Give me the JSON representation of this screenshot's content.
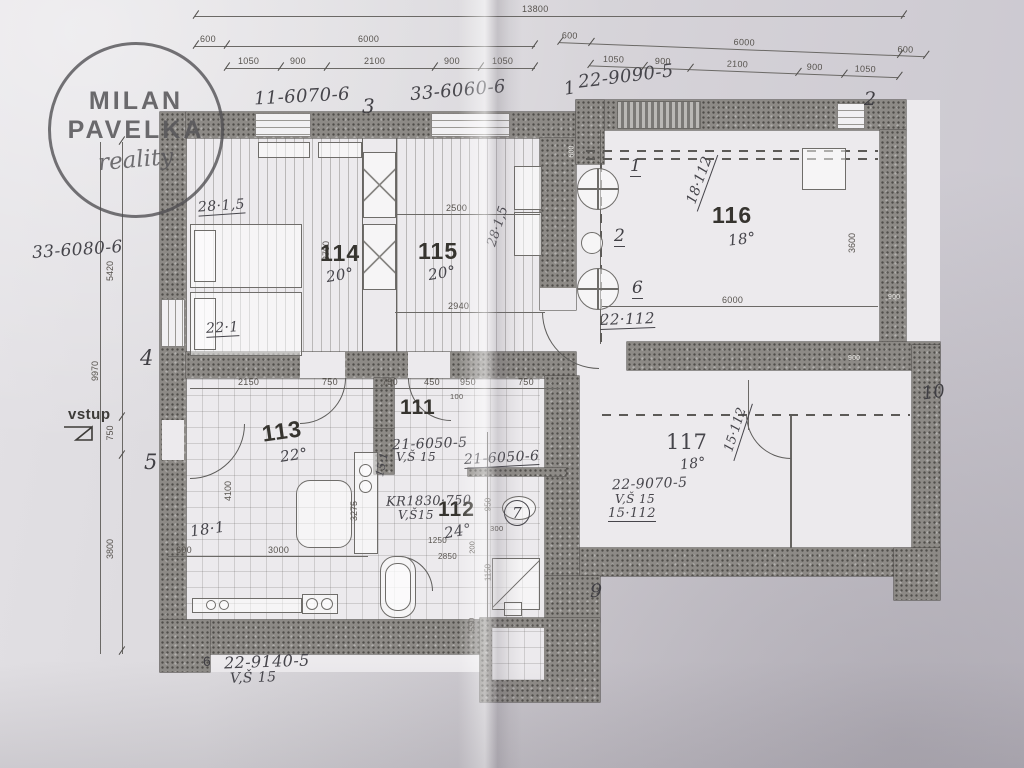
{
  "logo": {
    "line1": "MILAN",
    "line2": "PAVELKA",
    "line3": "reality"
  },
  "entrance": {
    "label": "vstup"
  },
  "rooms": {
    "r114": {
      "num": "114",
      "temp": "20°"
    },
    "r115": {
      "num": "115",
      "temp": "20°"
    },
    "r116": {
      "num": "116",
      "temp": "18°"
    },
    "r111": {
      "num": "111"
    },
    "r113": {
      "num": "113",
      "temp": "22°"
    },
    "r112": {
      "num": "112",
      "temp": "24°"
    },
    "r117": {
      "num": "117",
      "temp": "18°"
    }
  },
  "hand": {
    "ctl": "11-6070-6",
    "ctm": "33-6060-6",
    "ctr": "22-9090-5",
    "cl": "33-6080-6",
    "cb": "22-9140-5",
    "vsb": "V,Š 15",
    "a28": "28·1,5",
    "a28v": "28·1,5",
    "a18112": "18·112",
    "a221": "22·1",
    "a22112": "22·112",
    "a21505": "21-6050-5",
    "vs21": "V,Š 15",
    "a151": "15·1",
    "a21506": "21-6050-6",
    "kr": "KR1830·750",
    "vskr": "V,Š15",
    "a9070": "22-9070-5",
    "vs9070": "V,Š 15",
    "a15112": "15·112",
    "a15112v": "15·112",
    "a181": "18·1"
  },
  "markers": {
    "m1": "1",
    "m2": "2",
    "m3": "3",
    "m4": "4",
    "m5": "5",
    "m7": "7",
    "m9": "9",
    "m10": "10",
    "p6": "6",
    "r1": "1",
    "r2": "2",
    "r6": "6"
  },
  "dims": {
    "total": "13800",
    "tl600": "600",
    "tl6000": "6000",
    "tlsegs": [
      "1050",
      "900",
      "2100",
      "900",
      "1050"
    ],
    "tr600a": "600",
    "tr6000": "6000",
    "tr600b": "600",
    "trsegs": [
      "1050",
      "900",
      "2100",
      "900",
      "1050"
    ],
    "v9970": "9970",
    "v5420": "5420",
    "v750": "750",
    "v3800": "3800",
    "v3600": "3600",
    "d6000": "6000",
    "hall": [
      "2150",
      "750",
      "750",
      "450",
      "950",
      "750"
    ],
    "h100": "100",
    "d2500": "2500",
    "d2940": "2940",
    "v3700": "3700",
    "k600": "600",
    "k3000": "3000",
    "v4100": "4100",
    "v3275": "3275",
    "b1250": "1250",
    "b2850": "2850",
    "b300": "300",
    "v950": "950",
    "v1150": "1150",
    "v550": "550",
    "v200": "200",
    "w900a": "900",
    "w900b": "900",
    "w600": "600"
  }
}
